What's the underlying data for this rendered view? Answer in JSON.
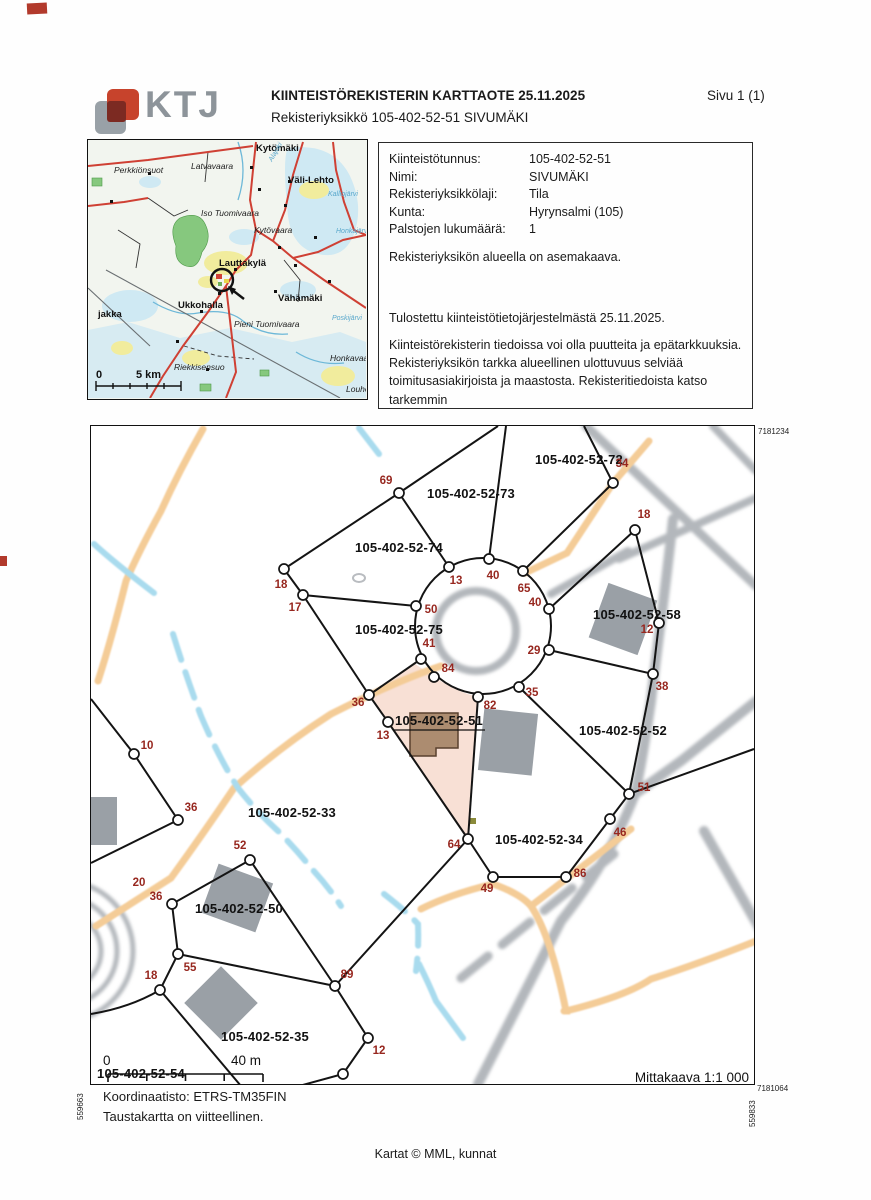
{
  "header": {
    "logo": "KTJ",
    "title": "KIINTEISTÖREKISTERIN KARTTAOTE 25.11.2025",
    "subtitle": "Rekisteriyksikkö 105-402-52-51 SIVUMÄKI",
    "page": "Sivu 1 (1)"
  },
  "info": {
    "rows": [
      {
        "label": "Kiinteistötunnus:",
        "value": "105-402-52-51"
      },
      {
        "label": "Nimi:",
        "value": "SIVUMÄKI"
      },
      {
        "label": "Rekisteriyksikkölaji:",
        "value": "Tila"
      },
      {
        "label": "Kunta:",
        "value": "Hyrynsalmi (105)"
      },
      {
        "label": "Palstojen lukumäärä:",
        "value": "1"
      }
    ],
    "zoning_note": "Rekisteriyksikön alueella on asemakaava.",
    "printed_note": "Tulostettu kiinteistötietojärjestelmästä 25.11.2025.",
    "disclaimer_lines": [
      "Kiinteistörekisterin tiedoissa voi olla puutteita ja epätarkkuuksia.",
      "Rekisteriyksikön tarkka alueellinen ulottuvuus selviää",
      "toimitusasiakirjoista ja maastosta. Rekisteritiedoista katso tarkemmin",
      "www.maanmittauslaitos.fi/rekisteritiedot."
    ]
  },
  "overview_map": {
    "scale_zero": "0",
    "scale_label": "5 km",
    "places_bold": [
      {
        "t": "Kytömäki",
        "x": 168,
        "y": 11
      },
      {
        "t": "Väli-Lehto",
        "x": 200,
        "y": 43
      },
      {
        "t": "Lauttakylä",
        "x": 131,
        "y": 126
      },
      {
        "t": "Ukkohalla",
        "x": 90,
        "y": 168
      },
      {
        "t": "Vähämäki",
        "x": 190,
        "y": 161
      },
      {
        "t": "jakka",
        "x": 10,
        "y": 177
      }
    ],
    "places_italic": [
      {
        "t": "Perkkiönsuot",
        "x": 26,
        "y": 33
      },
      {
        "t": "Latvavaara",
        "x": 103,
        "y": 29
      },
      {
        "t": "Iso Tuomivaara",
        "x": 113,
        "y": 76
      },
      {
        "t": "Kytövaara",
        "x": 166,
        "y": 93
      },
      {
        "t": "Pieni Tuomivaara",
        "x": 146,
        "y": 187
      },
      {
        "t": "Riekkisensuo",
        "x": 86,
        "y": 230
      },
      {
        "t": "Honkavaara",
        "x": 242,
        "y": 221
      },
      {
        "t": "Louhens",
        "x": 258,
        "y": 252
      }
    ],
    "places_water": [
      {
        "t": "Alajoki",
        "x": 184,
        "y": 22,
        "r": -60
      },
      {
        "t": "Kalliojärvi",
        "x": 240,
        "y": 56,
        "r": 0
      },
      {
        "t": "Honkajärvi",
        "x": 248,
        "y": 93,
        "r": 0
      },
      {
        "t": "Poskijärvi",
        "x": 244,
        "y": 180,
        "r": 0
      }
    ]
  },
  "main_map": {
    "corner_ne": "7181234",
    "corner_se": "7181064",
    "corner_w": "559663",
    "corner_e": "559833",
    "scale_zero": "0",
    "scale_label": "40 m",
    "scale_text": "Mittakaava 1:1 000",
    "parcels": [
      {
        "id": "105-402-52-72",
        "x": 488,
        "y": 38
      },
      {
        "id": "105-402-52-73",
        "x": 380,
        "y": 72
      },
      {
        "id": "105-402-52-74",
        "x": 308,
        "y": 126
      },
      {
        "id": "105-402-52-75",
        "x": 308,
        "y": 208
      },
      {
        "id": "105-402-52-58",
        "x": 546,
        "y": 193
      },
      {
        "id": "105-402-52-51",
        "x": 348,
        "y": 299,
        "underline": true
      },
      {
        "id": "105-402-52-52",
        "x": 532,
        "y": 309
      },
      {
        "id": "105-402-52-33",
        "x": 201,
        "y": 391
      },
      {
        "id": "105-402-52-34",
        "x": 448,
        "y": 418
      },
      {
        "id": "105-402-52-50",
        "x": 148,
        "y": 487
      },
      {
        "id": "105-402-52-35",
        "x": 174,
        "y": 615
      },
      {
        "id": "105-402-52-54",
        "x": 50,
        "y": 652
      }
    ],
    "markers": [
      {
        "n": "69",
        "x": 295,
        "y": 58
      },
      {
        "n": "34",
        "x": 531,
        "y": 41
      },
      {
        "n": "18",
        "x": 553,
        "y": 92
      },
      {
        "n": "18",
        "x": 190,
        "y": 162
      },
      {
        "n": "17",
        "x": 204,
        "y": 185
      },
      {
        "n": "13",
        "x": 365,
        "y": 158
      },
      {
        "n": "40",
        "x": 402,
        "y": 153
      },
      {
        "n": "65",
        "x": 433,
        "y": 166
      },
      {
        "n": "40",
        "x": 444,
        "y": 180
      },
      {
        "n": "50",
        "x": 340,
        "y": 187
      },
      {
        "n": "41",
        "x": 338,
        "y": 221
      },
      {
        "n": "29",
        "x": 443,
        "y": 228
      },
      {
        "n": "12",
        "x": 556,
        "y": 207
      },
      {
        "n": "84",
        "x": 357,
        "y": 246
      },
      {
        "n": "35",
        "x": 441,
        "y": 270
      },
      {
        "n": "38",
        "x": 571,
        "y": 264
      },
      {
        "n": "36",
        "x": 267,
        "y": 280
      },
      {
        "n": "82",
        "x": 399,
        "y": 283
      },
      {
        "n": "13",
        "x": 292,
        "y": 313
      },
      {
        "n": "10",
        "x": 56,
        "y": 323
      },
      {
        "n": "51",
        "x": 553,
        "y": 365
      },
      {
        "n": "36",
        "x": 100,
        "y": 385
      },
      {
        "n": "52",
        "x": 149,
        "y": 423
      },
      {
        "n": "46",
        "x": 529,
        "y": 410
      },
      {
        "n": "64",
        "x": 363,
        "y": 422
      },
      {
        "n": "86",
        "x": 489,
        "y": 451
      },
      {
        "n": "49",
        "x": 396,
        "y": 466
      },
      {
        "n": "20",
        "x": 48,
        "y": 460
      },
      {
        "n": "36",
        "x": 65,
        "y": 474
      },
      {
        "n": "18",
        "x": 60,
        "y": 553
      },
      {
        "n": "55",
        "x": 99,
        "y": 545
      },
      {
        "n": "89",
        "x": 256,
        "y": 552
      },
      {
        "n": "12",
        "x": 288,
        "y": 628
      }
    ]
  },
  "footer": {
    "coord_system": "Koordinaatisto: ETRS-TM35FIN",
    "map_note": "Taustakartta on viitteellinen.",
    "credit": "Kartat © MML, kunnat"
  }
}
